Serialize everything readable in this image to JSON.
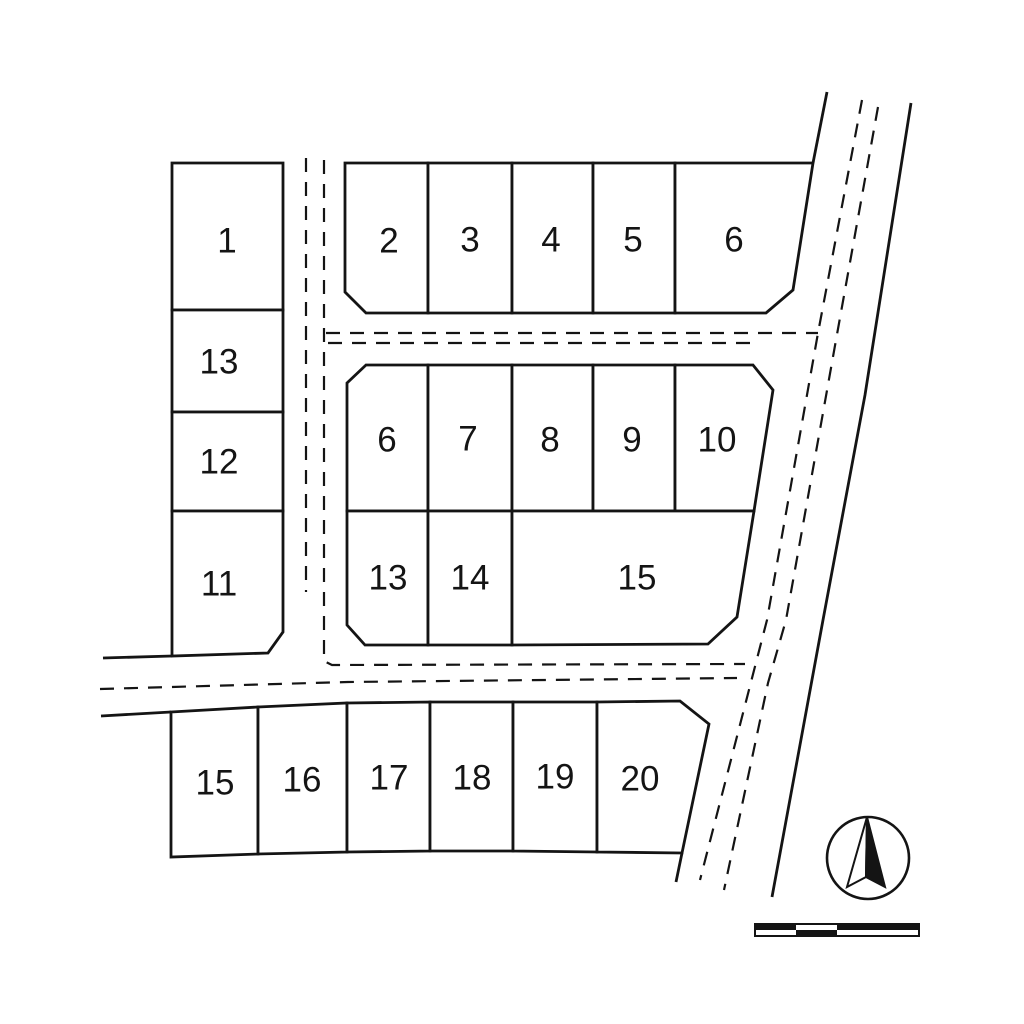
{
  "canvas": {
    "width": 1024,
    "height": 1024
  },
  "colors": {
    "background": "#ffffff",
    "line": "#141414"
  },
  "drawing_type": "subdivision-plat-map",
  "blocks": [
    {
      "id": "west",
      "lots": [
        {
          "label": "1",
          "points": [
            [
              172,
              163
            ],
            [
              283,
              163
            ],
            [
              283,
              310
            ],
            [
              172,
              310
            ]
          ],
          "label_xy": [
            227,
            241
          ]
        },
        {
          "label": "13",
          "points": [
            [
              172,
              310
            ],
            [
              283,
              310
            ],
            [
              283,
              412
            ],
            [
              172,
              412
            ]
          ],
          "label_xy": [
            219,
            362
          ]
        },
        {
          "label": "12",
          "points": [
            [
              172,
              412
            ],
            [
              283,
              412
            ],
            [
              283,
              511
            ],
            [
              172,
              511
            ]
          ],
          "label_xy": [
            219,
            462
          ]
        },
        {
          "label": "11",
          "points": [
            [
              172,
              511
            ],
            [
              283,
              511
            ],
            [
              283,
              632
            ],
            [
              268,
              653
            ],
            [
              172,
              656
            ]
          ],
          "label_xy": [
            219,
            584
          ]
        }
      ]
    },
    {
      "id": "north",
      "lots": [
        {
          "label": "2",
          "points": [
            [
              345,
              163
            ],
            [
              428,
              163
            ],
            [
              428,
              313
            ],
            [
              366,
              313
            ],
            [
              345,
              292
            ]
          ],
          "label_xy": [
            389,
            241
          ]
        },
        {
          "label": "3",
          "points": [
            [
              428,
              163
            ],
            [
              512,
              163
            ],
            [
              512,
              313
            ],
            [
              428,
              313
            ]
          ],
          "label_xy": [
            470,
            240
          ]
        },
        {
          "label": "4",
          "points": [
            [
              512,
              163
            ],
            [
              593,
              163
            ],
            [
              593,
              313
            ],
            [
              512,
              313
            ]
          ],
          "label_xy": [
            551,
            240
          ]
        },
        {
          "label": "5",
          "points": [
            [
              593,
              163
            ],
            [
              675,
              163
            ],
            [
              675,
              313
            ],
            [
              593,
              313
            ]
          ],
          "label_xy": [
            633,
            240
          ]
        },
        {
          "label": "6",
          "points": [
            [
              675,
              163
            ],
            [
              813,
              163
            ],
            [
              793,
              290
            ],
            [
              766,
              313
            ],
            [
              675,
              313
            ]
          ],
          "label_xy": [
            734,
            240
          ]
        }
      ]
    },
    {
      "id": "central",
      "lots": [
        {
          "label": "6",
          "points": [
            [
              366,
              365
            ],
            [
              428,
              365
            ],
            [
              428,
              511
            ],
            [
              347,
              511
            ],
            [
              347,
              383
            ]
          ],
          "label_xy": [
            387,
            440
          ]
        },
        {
          "label": "7",
          "points": [
            [
              428,
              365
            ],
            [
              512,
              365
            ],
            [
              512,
              511
            ],
            [
              428,
              511
            ]
          ],
          "label_xy": [
            468,
            439
          ]
        },
        {
          "label": "8",
          "points": [
            [
              512,
              365
            ],
            [
              593,
              365
            ],
            [
              593,
              511
            ],
            [
              512,
              511
            ]
          ],
          "label_xy": [
            550,
            440
          ]
        },
        {
          "label": "9",
          "points": [
            [
              593,
              365
            ],
            [
              675,
              365
            ],
            [
              675,
              511
            ],
            [
              593,
              511
            ]
          ],
          "label_xy": [
            632,
            440
          ]
        },
        {
          "label": "10",
          "points": [
            [
              675,
              365
            ],
            [
              753,
              365
            ],
            [
              773,
              390
            ],
            [
              754,
              511
            ],
            [
              675,
              511
            ]
          ],
          "label_xy": [
            717,
            440
          ]
        },
        {
          "label": "13",
          "points": [
            [
              347,
              511
            ],
            [
              428,
              511
            ],
            [
              428,
              645
            ],
            [
              365,
              645
            ],
            [
              347,
              625
            ]
          ],
          "label_xy": [
            388,
            578
          ]
        },
        {
          "label": "14",
          "points": [
            [
              428,
              511
            ],
            [
              512,
              511
            ],
            [
              512,
              645
            ],
            [
              428,
              645
            ]
          ],
          "label_xy": [
            470,
            578
          ]
        },
        {
          "label": "15",
          "points": [
            [
              512,
              511
            ],
            [
              754,
              511
            ],
            [
              737,
              617
            ],
            [
              708,
              644
            ],
            [
              512,
              645
            ]
          ],
          "label_xy": [
            637,
            578
          ]
        }
      ]
    },
    {
      "id": "south",
      "lots": [
        {
          "label": "15",
          "points": [
            [
              171,
              712
            ],
            [
              258,
              707
            ],
            [
              258,
              854
            ],
            [
              171,
              857
            ]
          ],
          "label_xy": [
            215,
            783
          ]
        },
        {
          "label": "16",
          "points": [
            [
              258,
              707
            ],
            [
              347,
              703
            ],
            [
              347,
              852
            ],
            [
              258,
              854
            ]
          ],
          "label_xy": [
            302,
            780
          ]
        },
        {
          "label": "17",
          "points": [
            [
              347,
              703
            ],
            [
              430,
              702
            ],
            [
              430,
              851
            ],
            [
              347,
              852
            ]
          ],
          "label_xy": [
            389,
            778
          ]
        },
        {
          "label": "18",
          "points": [
            [
              430,
              702
            ],
            [
              513,
              702
            ],
            [
              513,
              851
            ],
            [
              430,
              851
            ]
          ],
          "label_xy": [
            472,
            778
          ]
        },
        {
          "label": "19",
          "points": [
            [
              513,
              702
            ],
            [
              597,
              702
            ],
            [
              597,
              852
            ],
            [
              513,
              851
            ]
          ],
          "label_xy": [
            555,
            777
          ]
        },
        {
          "label": "20",
          "points": [
            [
              597,
              702
            ],
            [
              680,
              701
            ],
            [
              709,
              724
            ],
            [
              682,
              853
            ],
            [
              597,
              852
            ]
          ],
          "label_xy": [
            640,
            779
          ]
        }
      ]
    }
  ],
  "roads": {
    "edges": [
      {
        "name": "main-road-west-edge-upper",
        "points": [
          [
            827,
            92
          ],
          [
            813,
            163
          ]
        ]
      },
      {
        "name": "main-road-east-edge",
        "points": [
          [
            911,
            103
          ],
          [
            865,
            395
          ],
          [
            823,
            620
          ],
          [
            772,
            897
          ]
        ]
      },
      {
        "name": "main-road-west-edge-lower-stub",
        "points": [
          [
            682,
            853
          ],
          [
            676,
            882
          ]
        ]
      },
      {
        "name": "lot11-boundary-west-extension",
        "points": [
          [
            103,
            658
          ],
          [
            172,
            656
          ]
        ]
      },
      {
        "name": "south-block-boundary-west-extension",
        "points": [
          [
            101,
            716
          ],
          [
            171,
            712
          ]
        ]
      }
    ],
    "centerlines": [
      {
        "name": "west-road-dashed-left",
        "points": [
          [
            306,
            158
          ],
          [
            306,
            592
          ]
        ]
      },
      {
        "name": "west-road-dashed-right",
        "points": [
          [
            324,
            160
          ],
          [
            324,
            661
          ],
          [
            332,
            665
          ],
          [
            745,
            664
          ]
        ]
      },
      {
        "name": "middle-road-dashed-upper",
        "points": [
          [
            326,
            333
          ],
          [
            818,
            333
          ]
        ]
      },
      {
        "name": "middle-road-dashed-lower",
        "points": [
          [
            328,
            343
          ],
          [
            756,
            343
          ]
        ]
      },
      {
        "name": "south-road-dashed",
        "points": [
          [
            100,
            689
          ],
          [
            348,
            682
          ],
          [
            737,
            678
          ]
        ]
      },
      {
        "name": "main-road-dashed-left",
        "points": [
          [
            862,
            100
          ],
          [
            818,
            333
          ],
          [
            767,
            620
          ],
          [
            751,
            682
          ],
          [
            700,
            880
          ]
        ]
      },
      {
        "name": "main-road-dashed-right",
        "points": [
          [
            878,
            107
          ],
          [
            836,
            340
          ],
          [
            786,
            620
          ],
          [
            768,
            683
          ],
          [
            724,
            890
          ]
        ]
      }
    ]
  },
  "north_arrow": {
    "cx": 868,
    "cy": 858,
    "r": 41,
    "apex": [
      867,
      817
    ],
    "left": [
      847,
      887
    ],
    "notch": [
      866,
      877
    ],
    "right": [
      885,
      887
    ]
  },
  "scale_bar": {
    "x": 755,
    "y": 924,
    "width": 164,
    "height": 12,
    "div1": 796,
    "div2": 837
  }
}
